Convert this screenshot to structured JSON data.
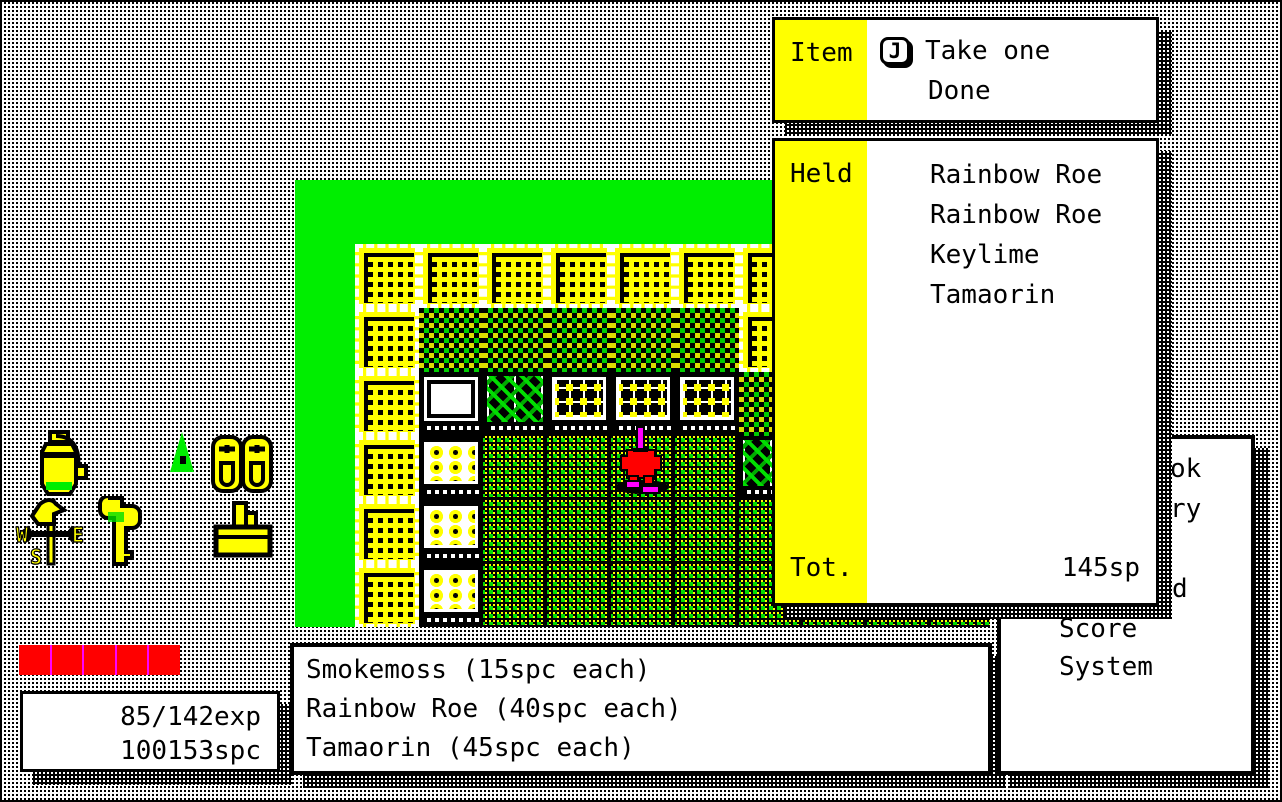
{
  "colors": {
    "green": "#00ee00",
    "yellow": "#ffff00",
    "red": "#ff0000",
    "magenta": "#ff00ff",
    "black": "#000000",
    "white": "#ffffff"
  },
  "item_menu": {
    "label": "Item",
    "key_label": "J",
    "options": [
      "Take one",
      "Done"
    ]
  },
  "held_panel": {
    "label": "Held",
    "items": [
      "Rainbow Roe",
      "Rainbow Roe",
      "Keylime",
      "Tamaorin"
    ],
    "total_label": "Tot.",
    "total_value": "145sp"
  },
  "system_menu": {
    "visible_fragments": [
      "ok",
      "ry",
      "d",
      "Score",
      "System"
    ]
  },
  "message_box": {
    "lines": [
      "Smokemoss (15spc each)",
      "Rainbow Roe (40spc each)",
      "Tamaorin (45spc each)"
    ]
  },
  "stats": {
    "exp": "85/142exp",
    "money": "100153spc"
  },
  "hp_bar": {
    "segments": 5
  },
  "inventory_icons": [
    "bottle",
    "weathervane",
    "key",
    "tree",
    "slippers",
    "basket"
  ],
  "map": {
    "legend": {
      "C": "crate",
      "H": "hedge",
      "W": "counter",
      "V": "veggie",
      "E": "eggs",
      "B": "bin",
      "F": "floor"
    },
    "rows": [
      "CCCCCCCCCC",
      "CHHHHHCHHH",
      "CWVEEEHFFF",
      "CBFFFFVFFF",
      "CBFFFFFFFF",
      "CBFFFFFFFF"
    ],
    "player": {
      "row": 3,
      "col": 4
    }
  }
}
